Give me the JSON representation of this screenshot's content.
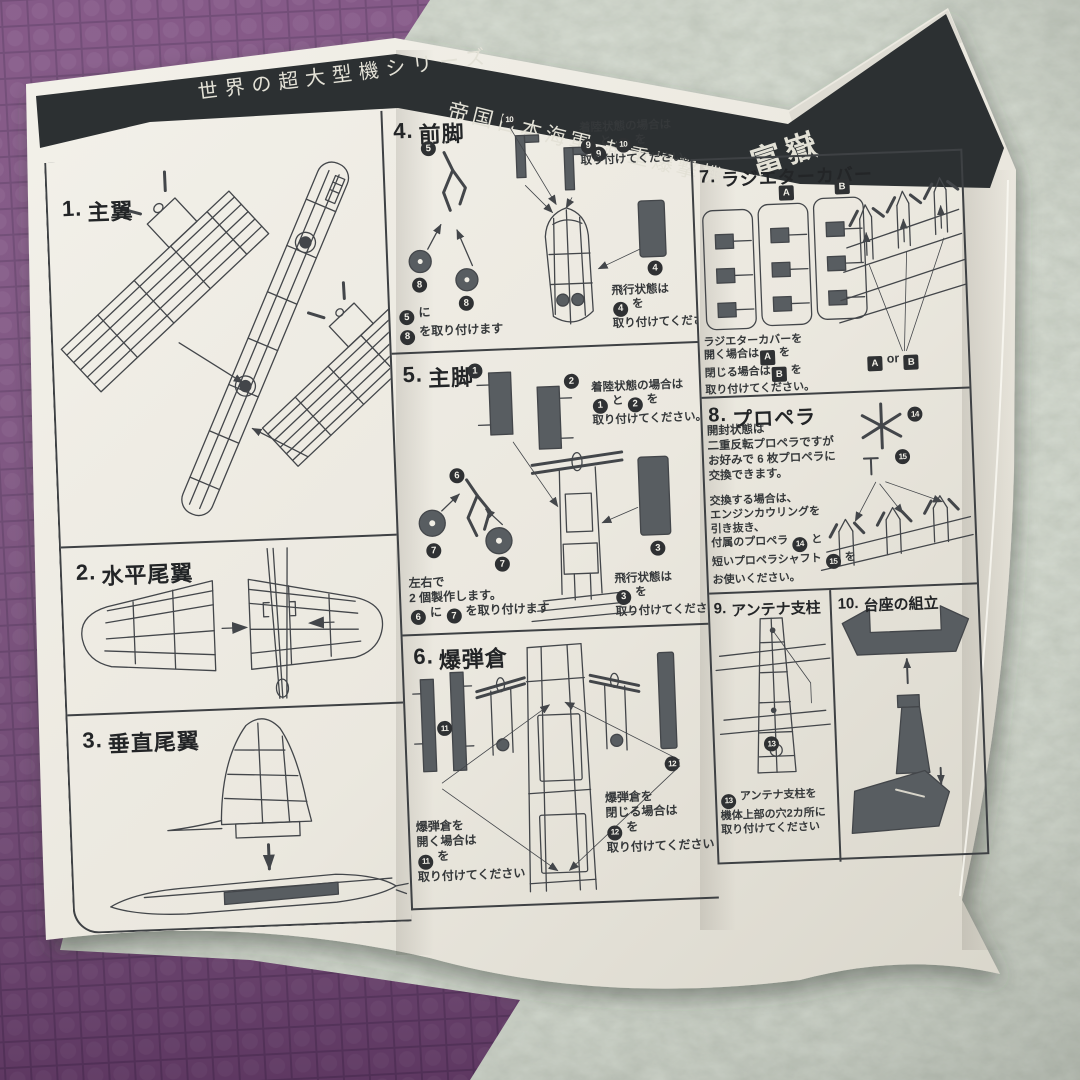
{
  "colors": {
    "paper": "#eeebe2",
    "band": "#2c3032",
    "ink": "#43464a",
    "part": "#585d61",
    "carpet": "#a6af9e",
    "mat": "#7b4c7e",
    "matline": "#603a67",
    "white_text": "#e3e1d6"
  },
  "header": {
    "series_title": "世界の超大型機シリーズ",
    "main_title": "帝国日本海軍 超重爆撃機",
    "model_name": "富嶽"
  },
  "sections": {
    "s1": {
      "num": "1.",
      "title": "主翼"
    },
    "s2": {
      "num": "2.",
      "title": "水平尾翼"
    },
    "s3": {
      "num": "3.",
      "title": "垂直尾翼"
    },
    "s4": {
      "num": "4.",
      "title": "前脚",
      "parts": [
        "10",
        "5",
        "8",
        "8",
        "9",
        "4"
      ],
      "landing": [
        [
          {
            "t": "着陸状態の場合は"
          }
        ],
        [
          {
            "n": "9"
          },
          {
            "t": " と "
          },
          {
            "n": "10"
          },
          {
            "t": " を"
          }
        ],
        [
          {
            "t": "取り付けてください。"
          }
        ]
      ],
      "attach": [
        [
          {
            "n": "5"
          },
          {
            "t": " に"
          }
        ],
        [
          {
            "n": "8"
          },
          {
            "t": " を取り付けます"
          }
        ]
      ],
      "flight": [
        [
          {
            "t": "飛行状態は"
          }
        ],
        [
          {
            "n": "4"
          },
          {
            "t": " を"
          }
        ],
        [
          {
            "t": "取り付けてください。"
          }
        ]
      ]
    },
    "s5": {
      "num": "5.",
      "title": "主脚",
      "parts": [
        "1",
        "2",
        "6",
        "7",
        "7",
        "3"
      ],
      "landing": [
        [
          {
            "t": "着陸状態の場合は"
          }
        ],
        [
          {
            "n": "1"
          },
          {
            "t": " と "
          },
          {
            "n": "2"
          },
          {
            "t": " を"
          }
        ],
        [
          {
            "t": "取り付けてください。"
          }
        ]
      ],
      "make": [
        [
          {
            "t": "左右で"
          }
        ],
        [
          {
            "t": "2 個製作します。"
          }
        ],
        [
          {
            "n": "6"
          },
          {
            "t": " に "
          },
          {
            "n": "7"
          },
          {
            "t": " を取り付けます"
          }
        ]
      ],
      "flight": [
        [
          {
            "t": "飛行状態は"
          }
        ],
        [
          {
            "n": "3"
          },
          {
            "t": " を"
          }
        ],
        [
          {
            "t": "取り付けてください"
          }
        ]
      ]
    },
    "s6": {
      "num": "6.",
      "title": "爆弾倉",
      "parts": [
        "11",
        "12"
      ],
      "open": [
        [
          {
            "t": "爆弾倉を"
          }
        ],
        [
          {
            "t": "開く場合は"
          }
        ],
        [
          {
            "n": "11"
          },
          {
            "t": " を"
          }
        ],
        [
          {
            "t": "取り付けてください"
          }
        ]
      ],
      "close": [
        [
          {
            "t": "爆弾倉を"
          }
        ],
        [
          {
            "t": "閉じる場合は"
          }
        ],
        [
          {
            "n": "12"
          },
          {
            "t": " を"
          }
        ],
        [
          {
            "t": "取り付けてください"
          }
        ]
      ]
    },
    "s7": {
      "num": "7.",
      "title": "ラジエターカバー",
      "sprue": [
        "A",
        "B"
      ],
      "note": [
        [
          {
            "t": "ラジエターカバーを"
          }
        ],
        [
          {
            "t": "開く場合は"
          },
          {
            "b": "A"
          },
          {
            "t": " を"
          }
        ],
        [
          {
            "t": "閉じる場合は"
          },
          {
            "b": "B"
          },
          {
            "t": " を"
          }
        ],
        [
          {
            "t": "取り付けてください。"
          }
        ]
      ],
      "aorb": [
        [
          {
            "b": "A"
          },
          {
            "t": " or "
          },
          {
            "b": "B"
          }
        ]
      ]
    },
    "s8": {
      "num": "8.",
      "title": "プロペラ",
      "parts": [
        "14",
        "15"
      ],
      "p1": [
        [
          {
            "t": "開封状態は"
          }
        ],
        [
          {
            "t": "二重反転プロペラですが"
          }
        ],
        [
          {
            "t": "お好みで 6 枚プロペラに"
          }
        ],
        [
          {
            "t": "交換できます。"
          }
        ]
      ],
      "p2": [
        [
          {
            "t": "交換する場合は、"
          }
        ],
        [
          {
            "t": "エンジンカウリングを"
          }
        ],
        [
          {
            "t": "引き抜き、"
          }
        ],
        [
          {
            "t": "付属のプロペラ "
          },
          {
            "n": "14"
          },
          {
            "t": " と"
          }
        ],
        [
          {
            "t": "短いプロペラシャフト "
          },
          {
            "n": "15"
          },
          {
            "t": " を"
          }
        ],
        [
          {
            "t": "お使いください。"
          }
        ]
      ]
    },
    "s9": {
      "num": "9.",
      "title": "アンテナ支柱",
      "parts": [
        "13"
      ],
      "note": [
        [
          {
            "n": "13"
          },
          {
            "t": " アンテナ支柱を"
          }
        ],
        [
          {
            "t": "機体上部の穴2カ所に"
          }
        ],
        [
          {
            "t": "取り付けてください"
          }
        ]
      ]
    },
    "s10": {
      "num": "10.",
      "title": "台座の組立"
    }
  }
}
